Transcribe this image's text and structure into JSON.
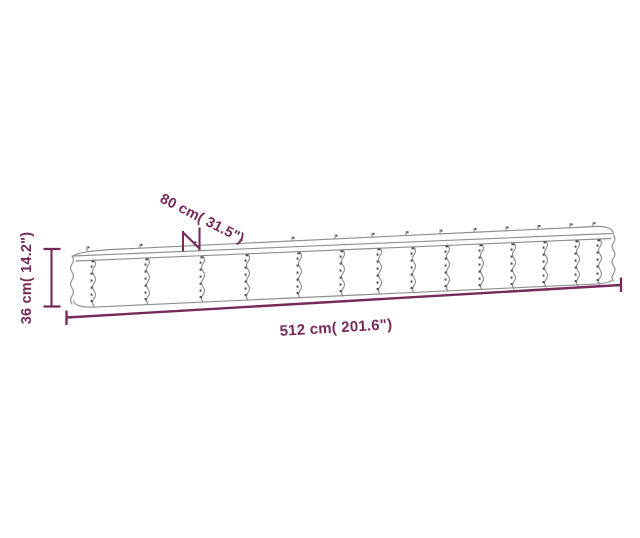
{
  "diagram": {
    "kind": "product-dimension-line-drawing",
    "subject": "long corrugated-metal raised garden bed, side view",
    "colors": {
      "dimension": "#772a59",
      "outline": "#8f8f8f",
      "rivet": "#4f4f4f",
      "background": "#ffffff"
    },
    "dimensions": {
      "length": {
        "label": "512 cm( 201.6\")",
        "value_cm": "512",
        "value_in": "201.6"
      },
      "width": {
        "label": "80 cm( 31.5\")",
        "value_cm": "80",
        "value_in": "31.5"
      },
      "height": {
        "label": "36 cm( 14.2\")",
        "value_cm": "36",
        "value_in": "14.2"
      }
    }
  }
}
